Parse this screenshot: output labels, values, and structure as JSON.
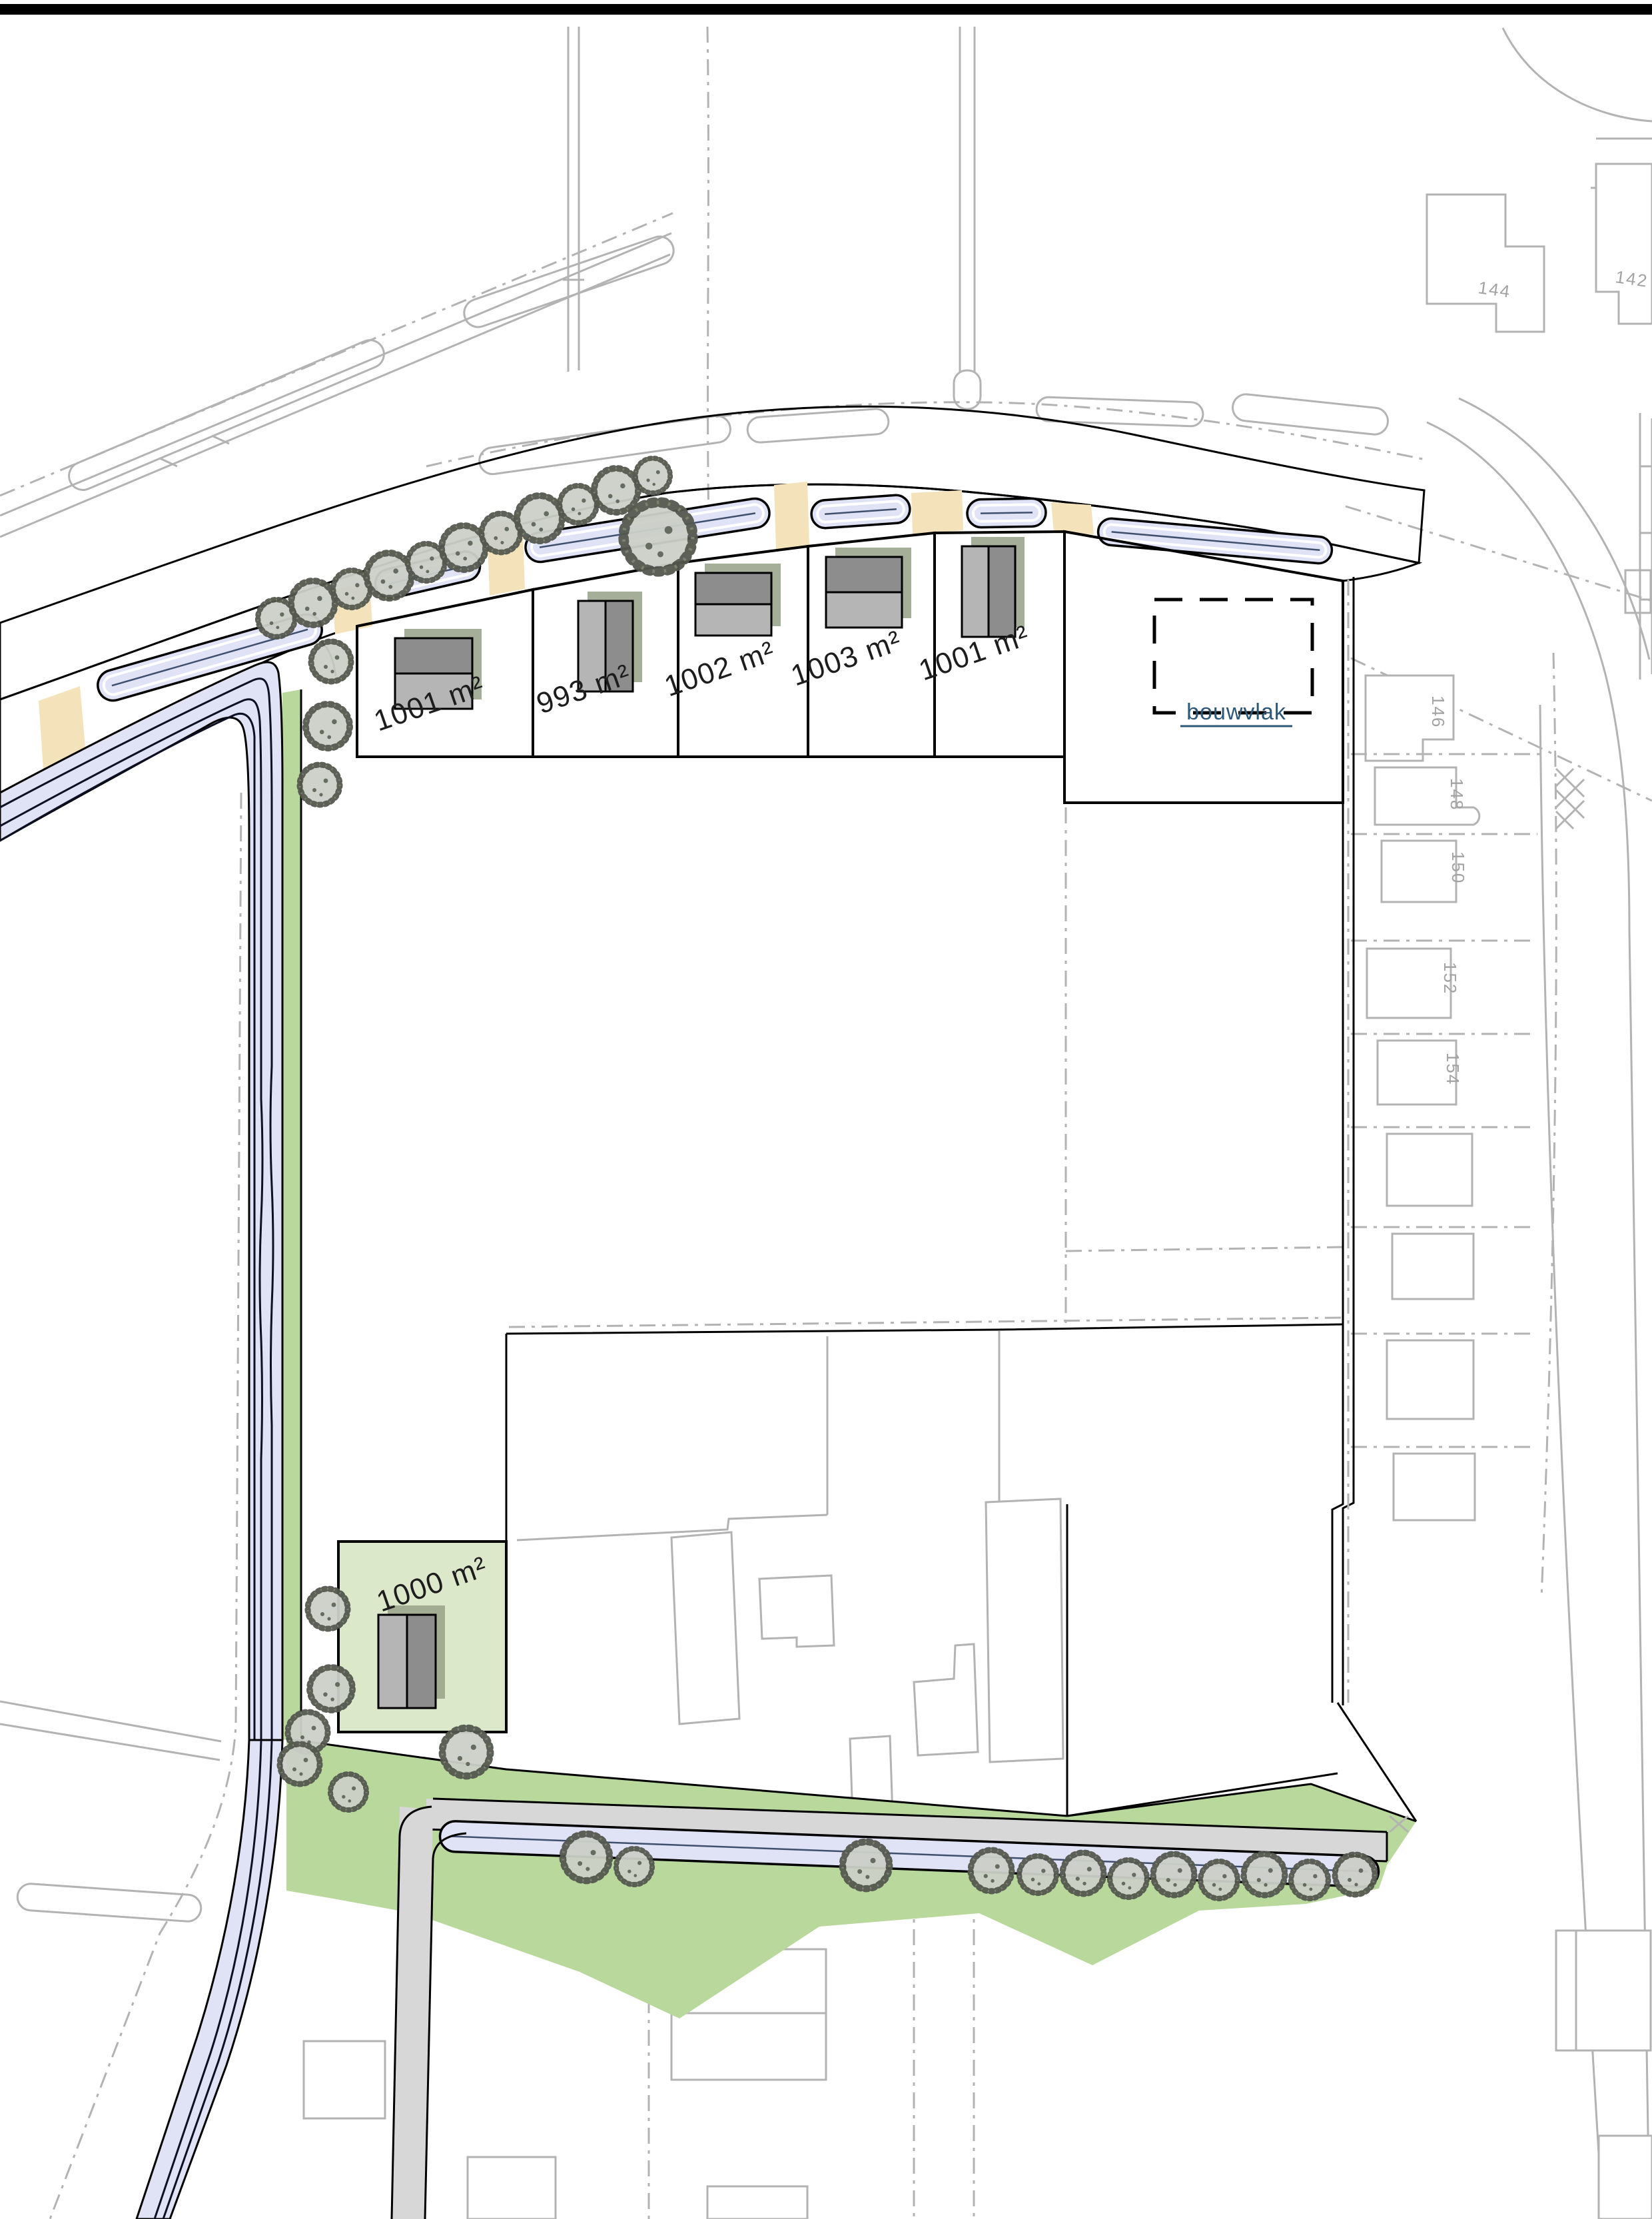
{
  "page": {
    "background": "#ffffff",
    "frame_color": "#000000"
  },
  "plots": [
    {
      "id": "plot-1",
      "area_label": "1001 m²"
    },
    {
      "id": "plot-2",
      "area_label": "993 m²"
    },
    {
      "id": "plot-3",
      "area_label": "1002 m²"
    },
    {
      "id": "plot-4",
      "area_label": "1003 m²"
    },
    {
      "id": "plot-5",
      "area_label": "1001 m²"
    },
    {
      "id": "plot-6",
      "area_label": "1000 m²"
    }
  ],
  "annotations": {
    "bouwvlak_label": "bouwvlak"
  },
  "cadastre": {
    "house_numbers": [
      "144",
      "142",
      "146",
      "148",
      "150",
      "152",
      "154"
    ]
  },
  "legend_icons": {
    "tree": "tree-symbol",
    "ditch": "water-ditch",
    "driveway": "driveway-access"
  },
  "colors": {
    "plot_green": "#dbe8ca",
    "verge_green": "#b9d89b",
    "road_gray": "#d7d7d7",
    "water_blue": "#e0e3f6",
    "driveway_beige": "#f4e2bb",
    "building_dark": "#8d8d8d",
    "building_light": "#b5b5b5",
    "building_shadow": "#9aa58d",
    "cadastral_gray": "#b3b3b3",
    "ink_black": "#000000",
    "bouwvlak_text_blue": "#2e5878",
    "ditch_centerline": "#3f4f6e"
  }
}
